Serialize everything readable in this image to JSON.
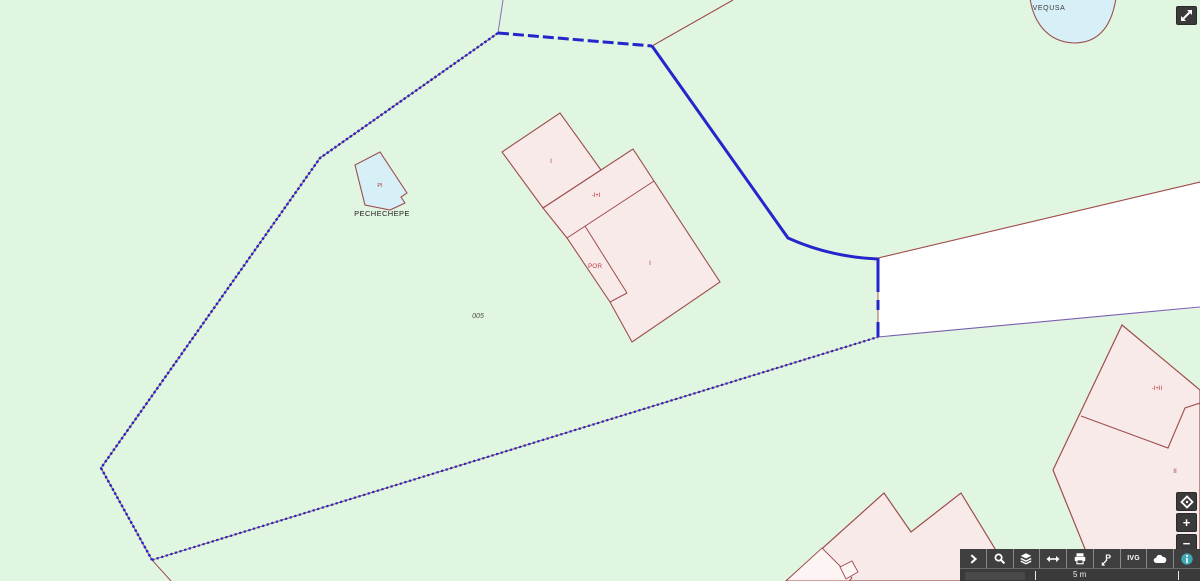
{
  "map": {
    "labels": {
      "pond_name": "VEQUSA",
      "water_parcel_name": "PECHECHEPE",
      "water_parcel_code": "PI",
      "building_a_floors": "I",
      "building_strip_floors": "-I+I",
      "building_por": "POR",
      "building_main_floors": "I",
      "parcel_number": "005",
      "building_se_floors": "-I+II",
      "building_se_lower_floors": "II"
    },
    "feature_colors": {
      "land_green": "#e0f6e0",
      "building_fill": "#f9eaea",
      "building_fill_light": "#fdf4f4",
      "building_stroke": "#9e4d4d",
      "water_fill": "#d7f0f8",
      "water_stroke": "#9c5050",
      "selection_blue": "#2525cc",
      "road_fill": "#ffffff",
      "road_top_stroke": "#a04848",
      "road_bottom_stroke": "#7a5fae",
      "label_red": "#b03535",
      "label_dark": "#222222"
    }
  },
  "toolbar": {
    "ivg_label": "IVG",
    "buttons": [
      {
        "name": "panel-expand"
      },
      {
        "name": "search"
      },
      {
        "name": "layers"
      },
      {
        "name": "measure-distance"
      },
      {
        "name": "print"
      },
      {
        "name": "identify-parcel"
      },
      {
        "name": "ivg"
      },
      {
        "name": "overview-map"
      },
      {
        "name": "info"
      }
    ],
    "info_accent": "#3fa9b8",
    "bar_background": "#3f3f3f"
  },
  "zoom_controls": {
    "zoom_in": "+",
    "zoom_out": "−"
  },
  "scalebar": {
    "distance_label": "5 m"
  }
}
